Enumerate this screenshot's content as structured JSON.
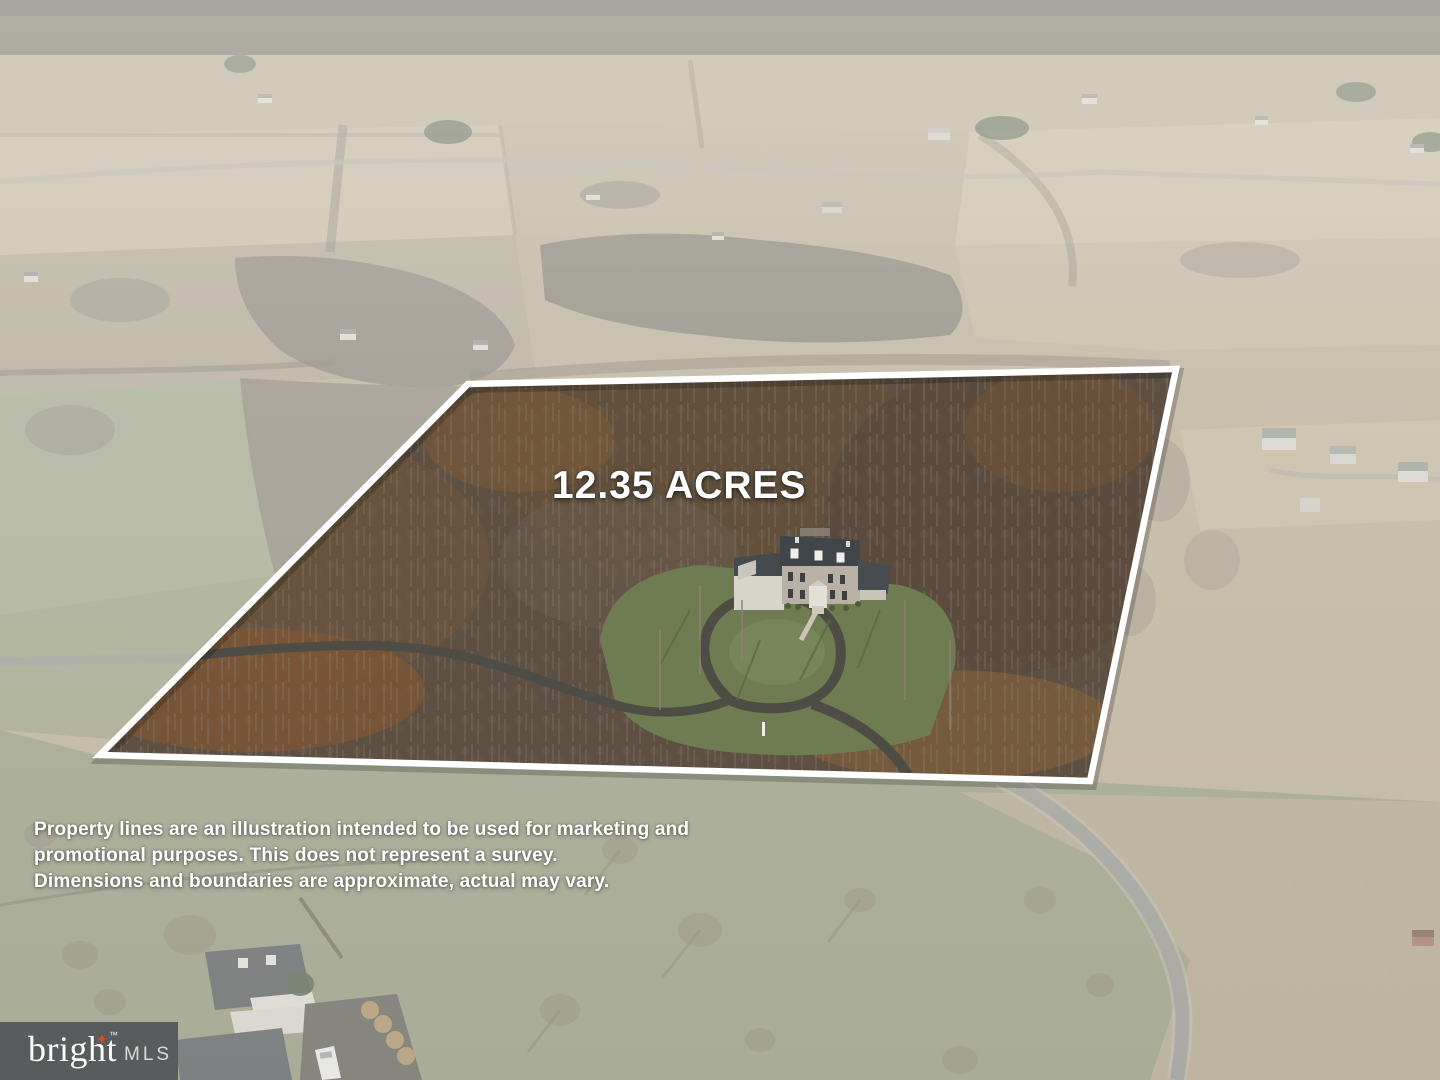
{
  "property": {
    "acres": "12.35"
  },
  "overlay": {
    "acreage_label": "12.35 ACRES",
    "disclaimer_lines": [
      "Property lines are an illustration intended to be used for marketing and",
      "promotional purposes. This does not represent a survey.",
      "Dimensions and boundaries are approximate, actual may vary."
    ]
  },
  "logo": {
    "brand": "bright",
    "trademark": "™",
    "suffix": "MLS"
  },
  "colors": {
    "boundary_line": "#ffffff",
    "overlay_text": "#ffffff",
    "haze": "#e9e7e1",
    "logo_background": "#56575a",
    "logo_star": "#e0491d",
    "interior_woods": "#5d4f42",
    "lawn_green": "#6f7c51"
  }
}
